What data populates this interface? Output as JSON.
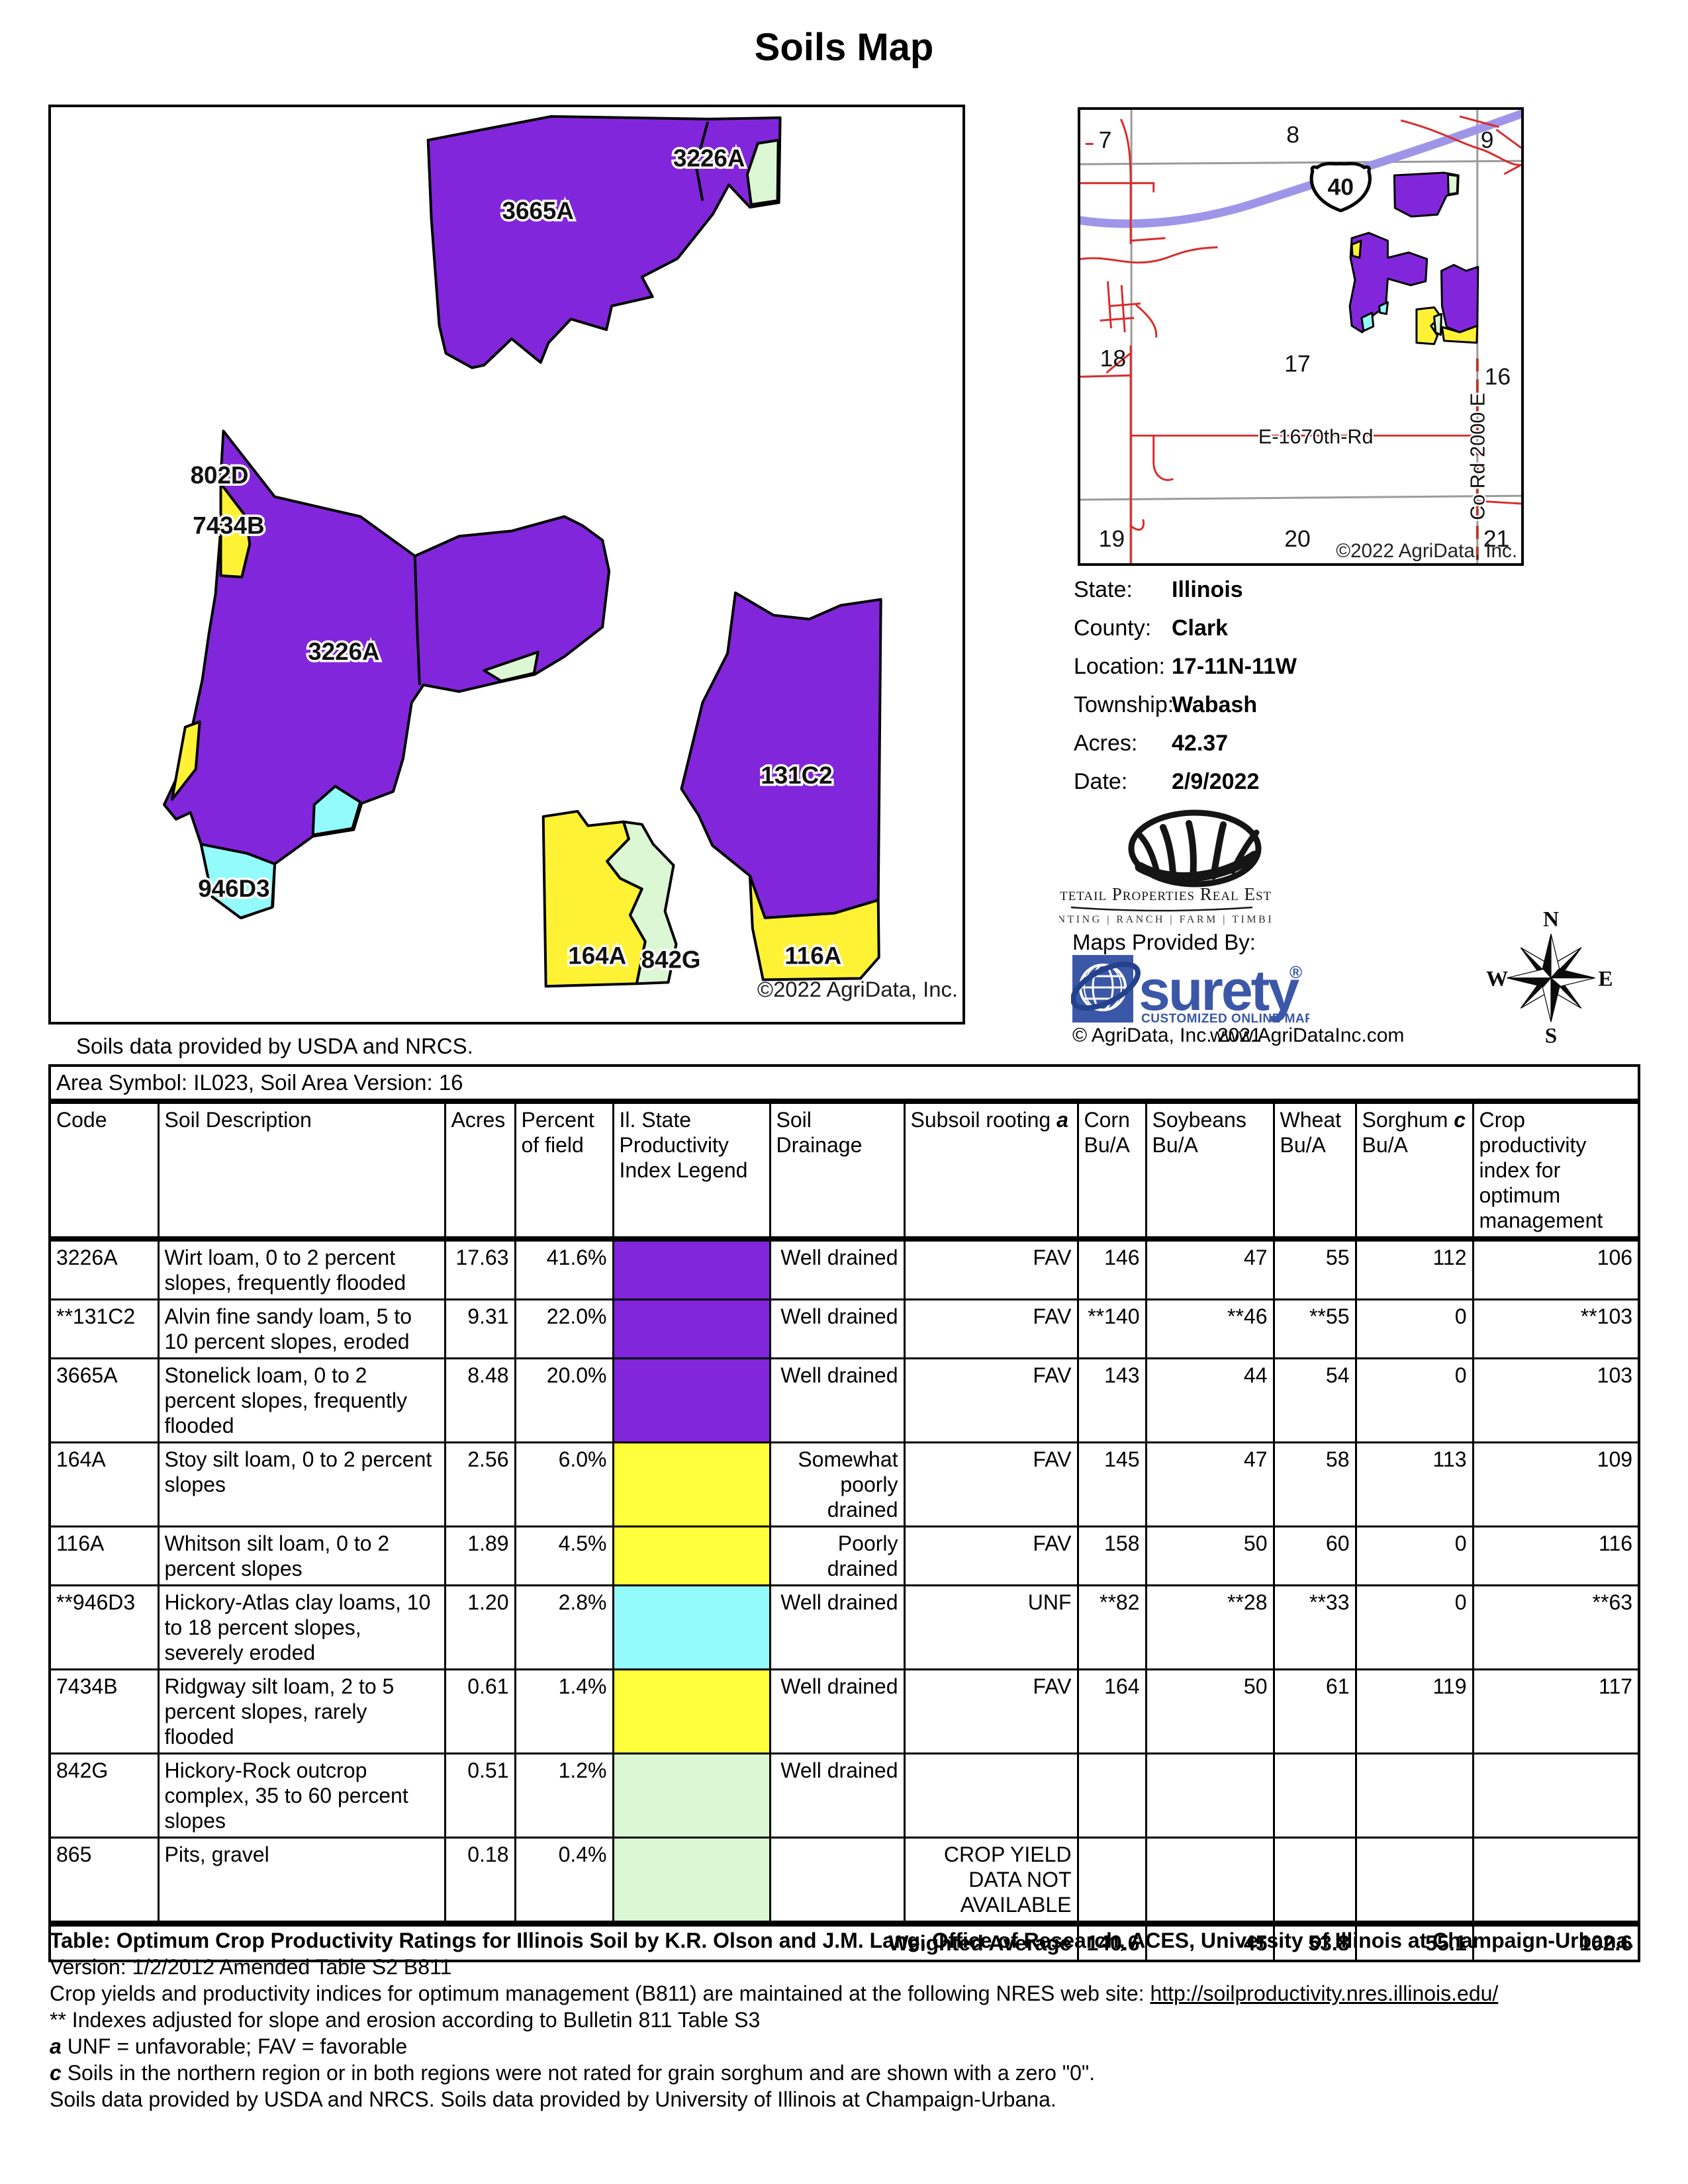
{
  "title": "Soils Map",
  "map": {
    "labels": [
      "3226A",
      "3665A",
      "802D",
      "7434B",
      "3226A",
      "131C2",
      "946D3",
      "164A",
      "842G",
      "116A"
    ],
    "copyright": "©2022 AgriData, Inc.",
    "source_note": "Soils data provided by USDA and NRCS.",
    "colors": {
      "purple": "#8226DB",
      "yellow": "#FFF235",
      "cyan": "#93FBFB",
      "green": "#DBF7D3"
    }
  },
  "locator": {
    "sections": [
      "7",
      "8",
      "9",
      "18",
      "17",
      "16",
      "19",
      "20",
      "21"
    ],
    "highway_shield": "40",
    "road_label_horizontal": "E-1670th-Rd",
    "road_label_vertical": "Co Rd 2000 E",
    "copyright": "©2022 AgriData, Inc."
  },
  "info": {
    "rows": [
      {
        "label": "State:",
        "value": "Illinois"
      },
      {
        "label": "County:",
        "value": "Clark"
      },
      {
        "label": "Location:",
        "value": "17-11N-11W"
      },
      {
        "label": "Township:",
        "value": "Wabash"
      },
      {
        "label": "Acres:",
        "value": "42.37"
      },
      {
        "label": "Date:",
        "value": "2/9/2022"
      }
    ]
  },
  "branding": {
    "company": "Whitetail Properties Real Estate",
    "tagline": "HUNTING | RANCH | FARM | TIMBER",
    "maps_provided_by": "Maps Provided By:",
    "surety_word": "surety",
    "surety_reg": "®",
    "surety_sub": "CUSTOMIZED ONLINE MAPPING",
    "surety_copyright": "© AgriData, Inc. 2021",
    "surety_website": "www.AgriDataInc.com",
    "surety_blue": "#3B57A8"
  },
  "compass": {
    "n": "N",
    "s": "S",
    "e": "E",
    "w": "W"
  },
  "table": {
    "area_header": "Area Symbol: IL023, Soil Area Version: 16",
    "legend_colors": {
      "purple": "#8226DB",
      "yellow": "#FFFF3B",
      "cyan": "#93FBFB",
      "green": "#DBF7D3"
    },
    "columns": [
      {
        "text": "Code"
      },
      {
        "text": "Soil Description"
      },
      {
        "text": "Acres"
      },
      {
        "text": "Percent\nof field"
      },
      {
        "text": "Il. State\nProductivity\nIndex Legend"
      },
      {
        "text": "Soil\nDrainage"
      },
      {
        "text": "Subsoil rooting ",
        "em": "a"
      },
      {
        "text": "Corn\nBu/A"
      },
      {
        "text": "Soybeans\nBu/A"
      },
      {
        "text": "Wheat\nBu/A"
      },
      {
        "text": "Sorghum ",
        "em": "c",
        "post": "\nBu/A"
      },
      {
        "text": "Crop\nproductivity\nindex for\noptimum\nmanagement"
      }
    ],
    "rows": [
      {
        "code": "3226A",
        "desc": "Wirt loam, 0 to 2 percent slopes, frequently flooded",
        "acres": "17.63",
        "pct": "41.6%",
        "color": "purple",
        "drainage": "Well drained",
        "subsoil": "FAV",
        "corn": "146",
        "soy": "47",
        "wheat": "55",
        "sorghum": "112",
        "cpi": "106"
      },
      {
        "code": "**131C2",
        "desc": "Alvin fine sandy loam, 5 to 10 percent slopes, eroded",
        "acres": "9.31",
        "pct": "22.0%",
        "color": "purple",
        "drainage": "Well drained",
        "subsoil": "FAV",
        "corn": "**140",
        "soy": "**46",
        "wheat": "**55",
        "sorghum": "0",
        "cpi": "**103"
      },
      {
        "code": "3665A",
        "desc": "Stonelick loam, 0 to 2 percent slopes, frequently flooded",
        "acres": "8.48",
        "pct": "20.0%",
        "color": "purple",
        "drainage": "Well drained",
        "subsoil": "FAV",
        "corn": "143",
        "soy": "44",
        "wheat": "54",
        "sorghum": "0",
        "cpi": "103"
      },
      {
        "code": "164A",
        "desc": "Stoy silt loam, 0 to 2 percent slopes",
        "acres": "2.56",
        "pct": "6.0%",
        "color": "yellow",
        "drainage": "Somewhat poorly drained",
        "subsoil": "FAV",
        "corn": "145",
        "soy": "47",
        "wheat": "58",
        "sorghum": "113",
        "cpi": "109"
      },
      {
        "code": "116A",
        "desc": "Whitson silt loam, 0 to 2 percent slopes",
        "acres": "1.89",
        "pct": "4.5%",
        "color": "yellow",
        "drainage": "Poorly drained",
        "subsoil": "FAV",
        "corn": "158",
        "soy": "50",
        "wheat": "60",
        "sorghum": "0",
        "cpi": "116"
      },
      {
        "code": "**946D3",
        "desc": "Hickory-Atlas clay loams, 10 to 18 percent slopes, severely eroded",
        "acres": "1.20",
        "pct": "2.8%",
        "color": "cyan",
        "drainage": "Well drained",
        "subsoil": "UNF",
        "corn": "**82",
        "soy": "**28",
        "wheat": "**33",
        "sorghum": "0",
        "cpi": "**63"
      },
      {
        "code": "7434B",
        "desc": "Ridgway silt loam, 2 to 5 percent slopes, rarely flooded",
        "acres": "0.61",
        "pct": "1.4%",
        "color": "yellow",
        "drainage": "Well drained",
        "subsoil": "FAV",
        "corn": "164",
        "soy": "50",
        "wheat": "61",
        "sorghum": "119",
        "cpi": "117"
      },
      {
        "code": "842G",
        "desc": "Hickory-Rock outcrop complex, 35 to 60 percent slopes",
        "acres": "0.51",
        "pct": "1.2%",
        "color": "green",
        "drainage": "Well drained",
        "subsoil": "",
        "corn": "",
        "soy": "",
        "wheat": "",
        "sorghum": "",
        "cpi": ""
      },
      {
        "code": "865",
        "desc": "Pits, gravel",
        "acres": "0.18",
        "pct": "0.4%",
        "color": "green",
        "drainage": "",
        "subsoil": "CROP YIELD\nDATA NOT\nAVAILABLE",
        "corn": "",
        "soy": "",
        "wheat": "",
        "sorghum": "",
        "cpi": ""
      }
    ],
    "weighted": {
      "label": "Weighted Average",
      "corn": "140.6",
      "soy": "45",
      "wheat": "53.8",
      "sorghum": "55.1",
      "cpi": "102.6"
    }
  },
  "footnotes": {
    "f1_bold": "Table: Optimum Crop Productivity Ratings for Illinois Soil by K.R. Olson and J.M. Lang, Office of Research, ACES, University of Illinois at Champaign-Urbana.",
    "f1_rest": " Version: 1/2/2012 Amended Table S2 B811",
    "f2_pre": "Crop yields and productivity indices for optimum management (B811) are maintained at the following NRES web site: ",
    "f2_link": "http://soilproductivity.nres.illinois.edu/",
    "f3": "** Indexes adjusted for slope and erosion according to Bulletin 811 Table S3",
    "f4_em": "a",
    "f4_rest": " UNF = unfavorable; FAV = favorable",
    "f5_em": "c",
    "f5_rest": " Soils in the northern region or in both regions were not rated for grain sorghum and are shown with a zero \"0\".",
    "f6": "Soils data provided by USDA and NRCS. Soils data provided by University of Illinois at Champaign-Urbana."
  }
}
